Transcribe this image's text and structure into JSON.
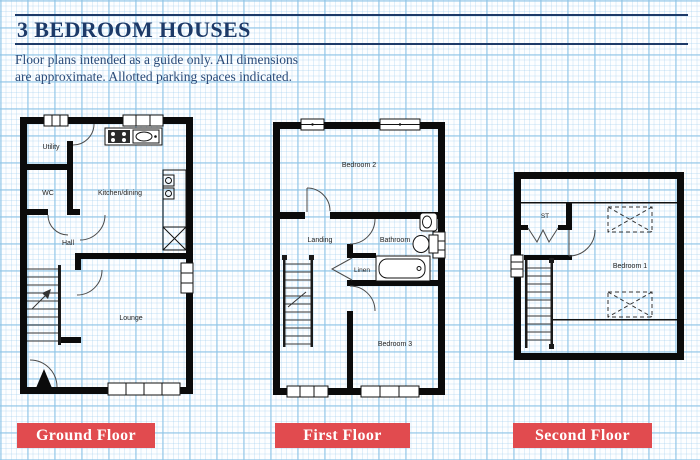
{
  "header": {
    "title": "3 BEDROOM HOUSES",
    "note_line1": "Floor plans intended as a guide only. All dimensions",
    "note_line2": "are approximate. Allotted parking spaces indicated."
  },
  "colors": {
    "navy": "#1d3a68",
    "red": "#e14b4f",
    "wall": "#0b0b0b",
    "grid_blue": "#8cc3e6"
  },
  "floors": {
    "ground": {
      "tag": "Ground Floor",
      "rooms": {
        "utility": "Utility",
        "wc": "WC",
        "kitchen": "Kitchen/dining",
        "hall": "Hall",
        "lounge": "Lounge"
      }
    },
    "first": {
      "tag": "First Floor",
      "rooms": {
        "bedroom2": "Bedroom 2",
        "landing": "Landing",
        "bathroom": "Bathroom",
        "linen": "Linen",
        "bedroom3": "Bedroom 3"
      }
    },
    "second": {
      "tag": "Second Floor",
      "rooms": {
        "st": "ST",
        "bedroom1": "Bedroom 1"
      }
    }
  }
}
